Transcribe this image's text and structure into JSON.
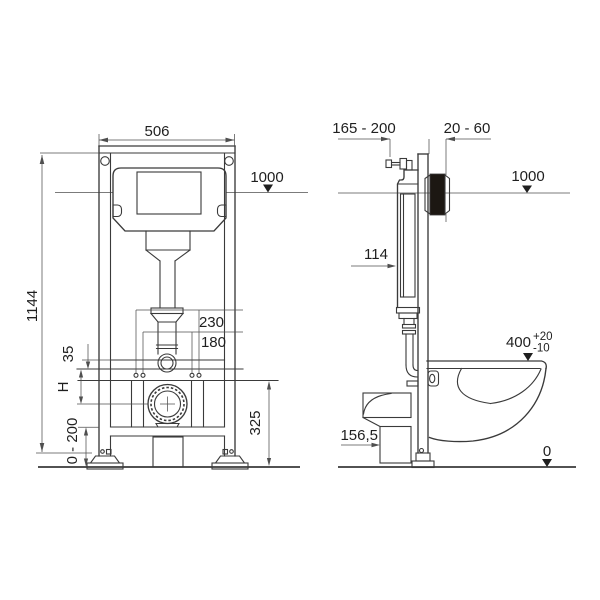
{
  "front": {
    "width": "506",
    "height": "1144",
    "level": "1000",
    "outer_spacing": "230",
    "inner_spacing": "180",
    "bracket_offset": "35",
    "fixing_height": "H",
    "leg_adjust_range": "0 - 200",
    "outlet_height": "325"
  },
  "side": {
    "depth_range": "165 - 200",
    "wall_thickness_range": "20 - 60",
    "level": "1000",
    "tank_depth": "114",
    "bowl_height": "400",
    "bowl_height_tol_plus": "+20",
    "bowl_height_tol_minus": "-10",
    "drain_height": "156,5",
    "floor_level": "0"
  },
  "colors": {
    "line": "#3a3a3a",
    "dim": "#4f4f4f",
    "text": "#1f1f1f",
    "plate": "#1c1712",
    "bg": "#ffffff"
  }
}
